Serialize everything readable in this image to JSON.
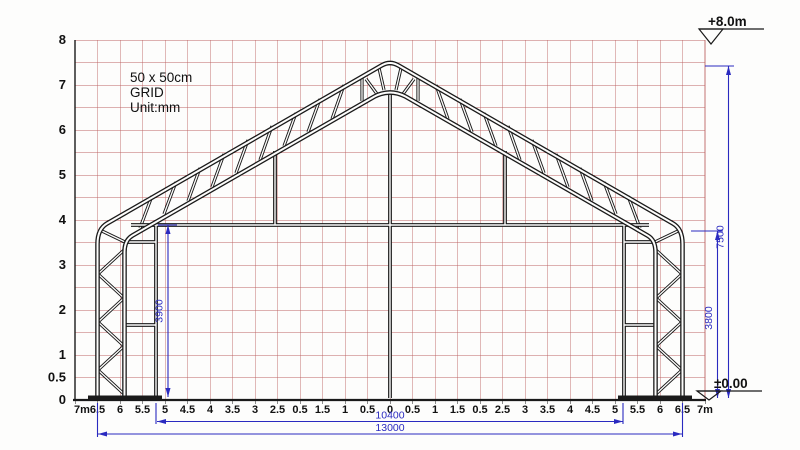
{
  "note": {
    "line1": "50 x 50cm",
    "line2": "GRID",
    "line3": "Unit:mm"
  },
  "levels": {
    "top": "+8.0m",
    "bottom": "±0.00"
  },
  "dims": {
    "overall_height": "7500",
    "eave_height": "3800",
    "door_height": "3900",
    "opening_width": "10400",
    "overall_width": "13000"
  },
  "axes": {
    "y_labels": [
      "8",
      "7",
      "6",
      "5",
      "4",
      "3",
      "2",
      "1",
      "0.5",
      "0"
    ],
    "x_labels": [
      "7m",
      "6.5",
      "6",
      "5.5",
      "5",
      "4.5",
      "4",
      "3.5",
      "3",
      "2.5",
      "0.5",
      "1.5",
      "1",
      "0.5",
      "0",
      "0.5",
      "1",
      "1.5",
      "0.5",
      "2.5",
      "3",
      "3.5",
      "4",
      "4.5",
      "5",
      "5.5",
      "6",
      "6.5",
      "7m"
    ]
  },
  "colors": {
    "grid_line": "#bd6363",
    "dimension": "#2a2ac0",
    "structure": "#1a1a1a",
    "background": "#fdfdfc"
  }
}
